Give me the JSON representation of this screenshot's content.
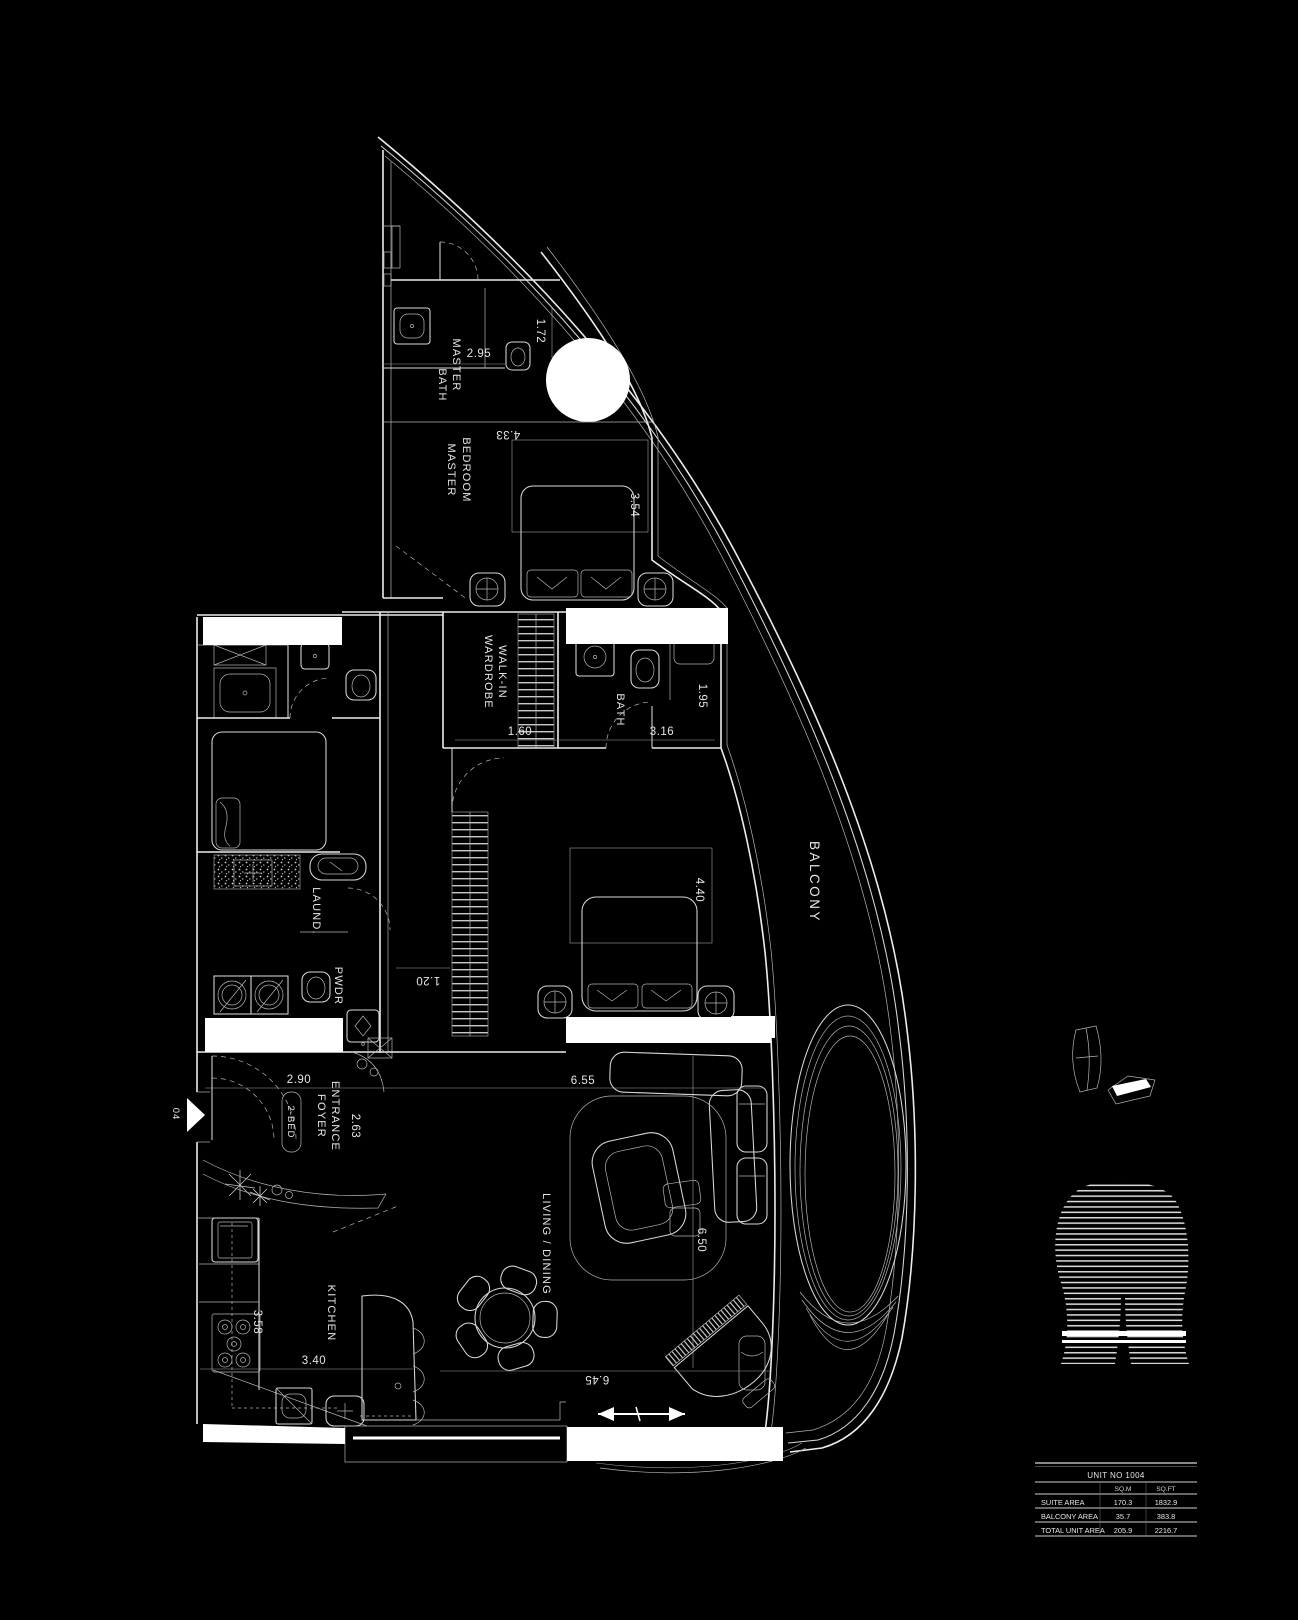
{
  "colors": {
    "background": "#000000",
    "line": "#ececec",
    "text": "#e6e6e6"
  },
  "rooms": {
    "master_bath": {
      "line1": "MASTER",
      "line2": "BATH"
    },
    "master_bedroom": {
      "line1": "MASTER",
      "line2": "BEDROOM"
    },
    "walk_in_wardrobe": {
      "line1": "WALK-IN",
      "line2": "WARDROBE"
    },
    "bath": {
      "label": "BATH"
    },
    "laundry": {
      "label": "LAUND."
    },
    "powder": {
      "label": "PWDR"
    },
    "entrance_foyer": {
      "line1": "ENTRANCE",
      "line2": "FOYER"
    },
    "unit_type_tag": "2-BED",
    "kitchen": {
      "label": "KITCHEN"
    },
    "living_dining": {
      "label": "LIVING / DINING"
    },
    "balcony": {
      "label": "BALCONY"
    }
  },
  "dimensions": {
    "master_bath_width": "2.95",
    "master_bath_depth": "1.72",
    "master_bedroom_width": "4.33",
    "master_bedroom_depth": "3.54",
    "wardrobe_width": "1.60",
    "bath_width": "3.16",
    "bath_depth": "1.95",
    "bedroom2_depth": "4.40",
    "corridor_width": "1.20",
    "foyer_width": "2.90",
    "foyer_depth": "2.63",
    "kitchen_depth": "3.58",
    "kitchen_width": "3.40",
    "living_width": "6.55",
    "living_depth": "6.50",
    "living_south_width": "6.45"
  },
  "entry_marker": "04",
  "area_table": {
    "title": "UNIT NO 1004",
    "col_sqm": "SQ.M",
    "col_sqft": "SQ.FT",
    "rows": [
      {
        "label": "SUITE AREA",
        "sqm": "170.3",
        "sqft": "1832.9"
      },
      {
        "label": "BALCONY AREA",
        "sqm": "35.7",
        "sqft": "383.8"
      },
      {
        "label": "TOTAL UNIT AREA",
        "sqm": "205.9",
        "sqft": "2216.7"
      }
    ]
  }
}
